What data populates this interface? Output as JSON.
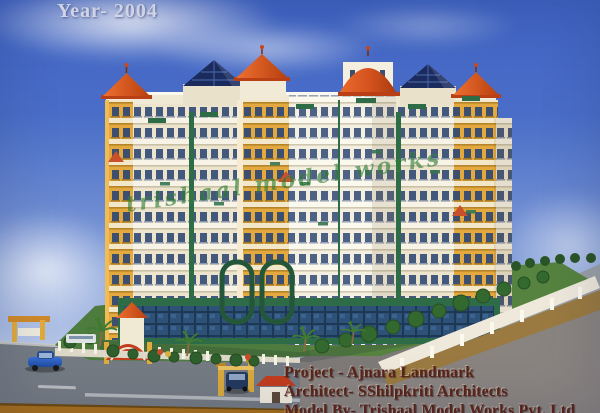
{
  "photo": {
    "year_label": "Year- 2004",
    "watermark": "trishaal model works",
    "credits": {
      "project": "Project - Ajnara Landmark",
      "architect": "Architect- SShilpkriti Architects",
      "model_by": "Model By- Trishaal Model Works Pvt. Ltd"
    }
  },
  "colors": {
    "sky_top": "#3f63c2",
    "sky_mid": "#7d99d6",
    "sky_horizon": "#ccd7ee",
    "facade_cream": "#efe7d0",
    "facade_yellow": "#e4a83d",
    "facade_white": "#f4f0e2",
    "roof_orange": "#d2511e",
    "roof_navy": "#1b2b5e",
    "accent_green": "#2e6b47",
    "glass_blue": "#35597e",
    "lawn_green": "#4e7c3e",
    "road_gray": "#747b83",
    "pavement_gray": "#8a8481",
    "platform_tan": "#9a7a40",
    "base_strip_orange": "#a8701c",
    "credits_text": "#5c241a",
    "year_text": "#dde1f2",
    "watermark_green": "#2e7d32"
  }
}
